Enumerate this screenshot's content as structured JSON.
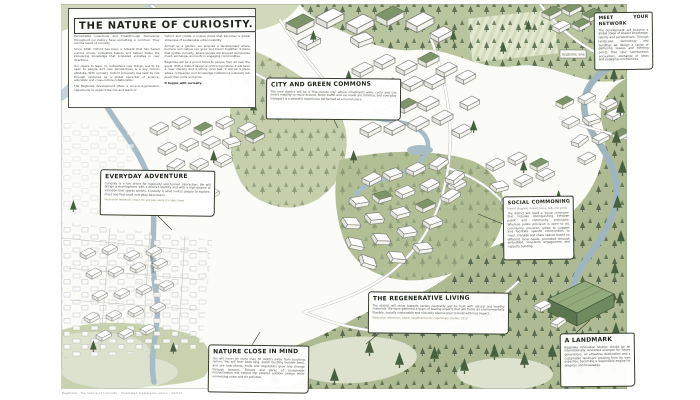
{
  "title_block": {
    "title": "THE NATURE OF CURIOSITY.",
    "left": [
      "Remarkable inventions and breakthrough discoveries throughout our history have something in common: They are the result of curiosity.",
      "Since 1096, Oxford has been a hotspot that has fueled curious minds, cultivated talents and helped foster the pioneering knowledge that propelled societies in new directions.",
      "Our desire to learn, to understand new things, and to be open to people and new perspectives is a key human attribute. With curiosity, Oxford University has kept its role through centuries as a global epicenter of science, education and cross-culture collaboration.",
      "The Begbroke development offers a once-in-a-generation opportunity to expand the role and reach of"
    ],
    "right": [
      "Oxford and create a unique place that becomes a global showcase of sustainable urban livability.",
      "Almost as a garden, we propose a development where humans and nature can grow and bloom together. A place that ignites curiosity, where senses are aroused and people meet, exchange, and unify in engaging communities.",
      "Begbroke will be a proud home to people from all over the world. With a district design and thriving nature, it will have a clear identity and a strong local feel. It will be a place where companies and knowledge institutions naturally will plant their roots and grow."
    ],
    "closing": "It begins with curiosity."
  },
  "callouts": {
    "meet": {
      "heading": "MEET YOUR NETWORK",
      "body": "The development will become a global stage of shared knowledge, talents and perspectives. Through landscape, technology and buildings we design a range of gathering spaces and meeting points that spur spontaneous encounters, exchange of ideas and engaging communities."
    },
    "commons": {
      "heading": "CITY AND GREEN COMMONS",
      "body": "The new district will be a 'five-minute city' where inhabitants walk, cycle and use smart mobility to move around. Noisy traffic and car roads are minimal, and everyday transport is a peaceful experience performed at a human pace."
    },
    "adventure": {
      "heading": "EVERYDAY ADVENTURE",
      "body": "Curiosity is a key driver for ingenuity and human interaction. We will design a development with a distinct identity and with a high degree of variation that sparks senses. Curiosity is what invites people to explore, meet and find small everyday adventures.",
      "caption": "Illustration reference: street life and play along the high street"
    },
    "social": {
      "heading": "SOCIAL COMMONING",
      "note": "District diagram: shared rooms, halls and yards",
      "body": "The district will need a 'social commons' that includes distinguishing between public and community provisions. Whereas public provision is open to all, community provision grows to support and facilitate specific communities to meet, manage and share spaces based on different local needs, promoted through embedded, long-term engagement and capacity building."
    },
    "regen": {
      "heading": "THE REGENERATIVE LIVING",
      "body": "The district will strive towards carbon neutrality and be built with natural and healthy materials. We have gathered a team of leading experts that will frame an environmentally feasible, socially sustainable and naturally diverse plan to build with less impact.",
      "caption": "Illustration references: timber neighbourhoods, Copenhagen studies, 2019"
    },
    "nature": {
      "heading": "NATURE CLOSE IN MIND",
      "body": "You will never be more than 50 meters away from touching nature. You will hear birds sing, watch bustling bumble bees, and see how plants, fruits and vegetables grow and change through seasons. Forests and parks of sustainable microclimates will extend the peoples outdoor season while minimizing noise and air pollution."
    },
    "landmark": {
      "heading": "A LANDMARK",
      "body": "Begbroke Innovation District should be an internationally renowned example for future generations, an attractive destination and a sustainable landmark growing from its own expertise, becoming a responsible engine for progress and knowledge."
    }
  },
  "labels": {
    "road_box": "begbroke lane",
    "road_diag": "woodstock road",
    "canal": "oxford canal"
  },
  "credit": "Begbroke · the nature of curiosity · illustrated masterplan vision · Oxford",
  "colors": {
    "paper": "#fbfbf7",
    "green_light": "#c6cfab",
    "green_mid": "#b2bf95",
    "green_dark": "#47603f",
    "water": "#a7bcc6",
    "ink": "#363d2f"
  }
}
